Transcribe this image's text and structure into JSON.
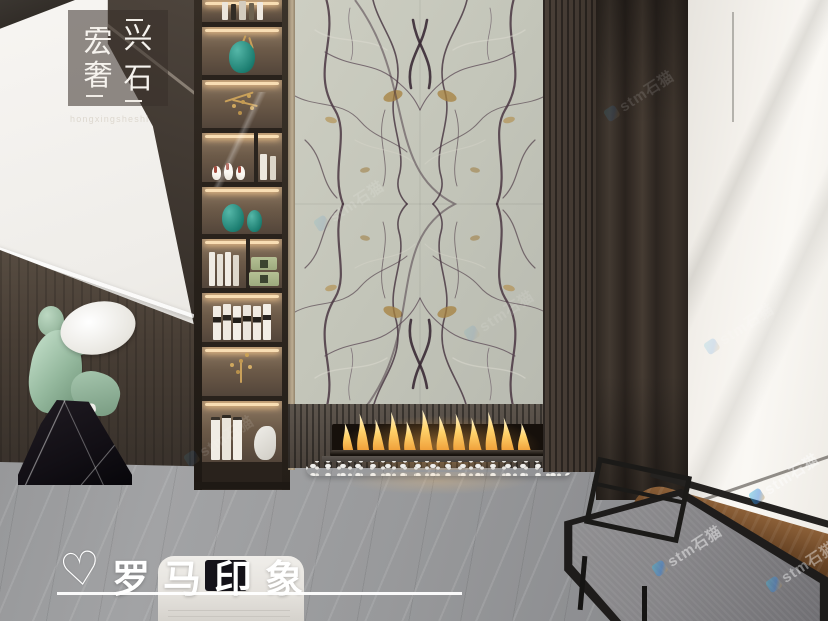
{
  "branding": {
    "logo": {
      "chars": [
        "宏",
        "兴",
        "奢",
        "石"
      ],
      "subtext": "hongxingsheshi"
    },
    "signature": {
      "heart": "♡",
      "text": "罗马印象"
    }
  },
  "watermark": {
    "text": "stm石猫"
  },
  "palette": {
    "marble_base": "#c7c8bc",
    "marble_vein_dark": "#46333f",
    "marble_vein_gold": "#a5803e",
    "wood_dark": "#3e362e",
    "curtain_brown": "#362e28",
    "window_light": "#f1eee9",
    "floor_gray": "#9b9c9e",
    "flame_orange": "#f2a13c",
    "teal_vase": "#2a9183",
    "statue_green": "#a4c6ae",
    "statue_base_black": "#17141a"
  }
}
